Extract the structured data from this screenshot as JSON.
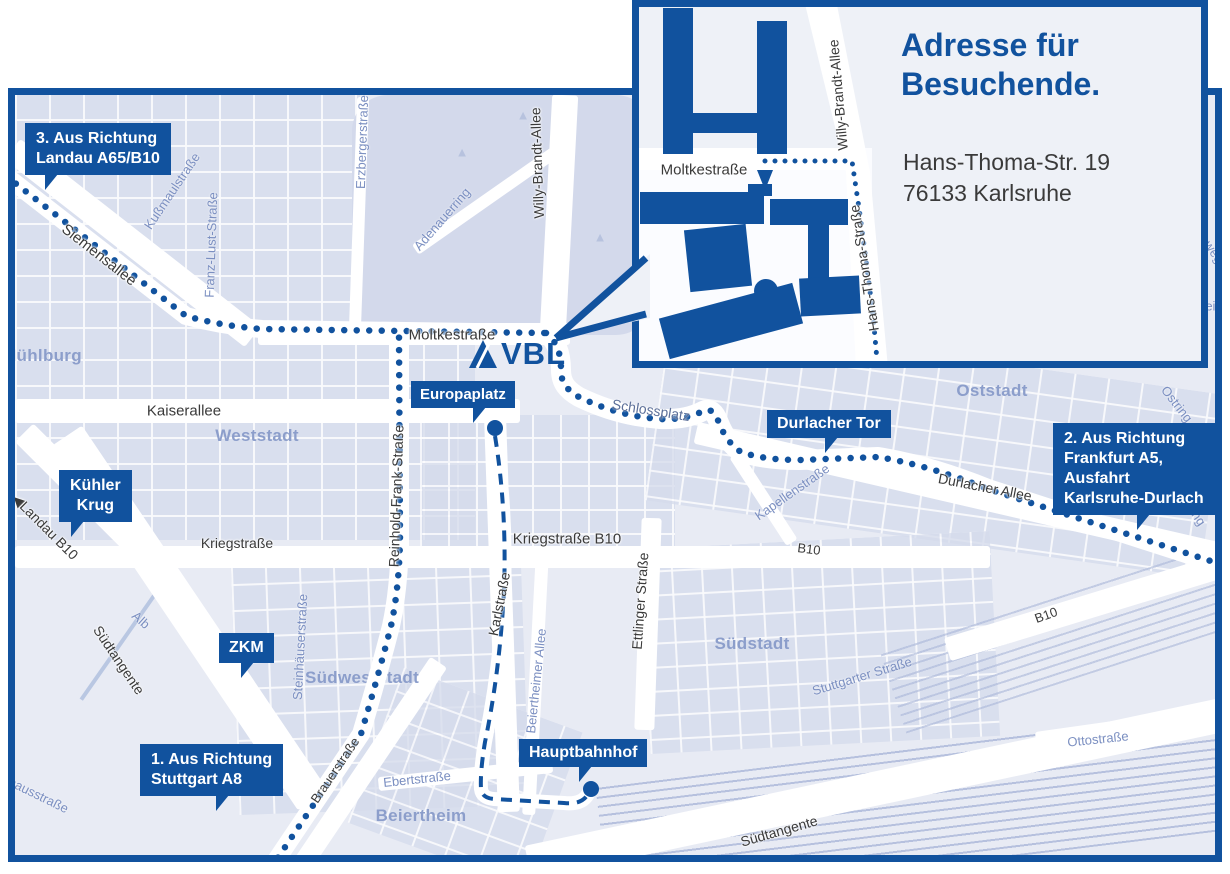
{
  "colors": {
    "brand_blue": "#11529e",
    "map_background": "#e8ebf4",
    "city_block": "#d5dbec",
    "park": "#d3d9eb",
    "area_label": "#8c9ecb",
    "street_minor": "#7b8fc1",
    "street_dark": "#3a3a3a",
    "route": "#11529e",
    "road_white": "#ffffff"
  },
  "inset": {
    "title": [
      "Adresse für",
      "Besuchende."
    ],
    "address": [
      "Hans-Thoma-Str. 19",
      "76133 Karlsruhe"
    ],
    "streets": {
      "moltkestrasse": "Moltkestraße",
      "willy_brandt_allee": "Willy-Brandt-Allee",
      "hans_thoma_strasse": "Hans-Thoma-Straße"
    }
  },
  "logo": {
    "text": "VBL"
  },
  "callouts": {
    "landau": {
      "lines": [
        "3. Aus Richtung",
        "Landau A65/B10"
      ]
    },
    "kuehler_krug": {
      "lines": [
        "Kühler",
        "Krug"
      ]
    },
    "zkm": {
      "lines": [
        "ZKM"
      ]
    },
    "stuttgart": {
      "lines": [
        "1. Aus Richtung",
        "Stuttgart A8"
      ]
    },
    "europaplatz": {
      "lines": [
        "Europaplatz"
      ]
    },
    "durlacher_tor": {
      "lines": [
        "Durlacher Tor"
      ]
    },
    "frankfurt": {
      "lines": [
        "2. Aus Richtung",
        "Frankfurt A5,",
        "Ausfahrt",
        "Karlsruhe-Durlach"
      ]
    },
    "hauptbahnhof": {
      "lines": [
        "Hauptbahnhof"
      ]
    }
  },
  "areas": {
    "muehlburg": "Mühlburg",
    "weststadt": "Weststadt",
    "oststadt": "Oststadt",
    "suedstadt": "Südstadt",
    "suedweststadt": "Südweststadt",
    "beiertheim": "Beiertheim"
  },
  "streets": {
    "siemensallee": "Siemensallee",
    "kussmaulstrasse": "Kußmaulstraße",
    "franz_lust_strasse": "Franz-Lust-Straße",
    "erzbergerstrasse": "Erzbergerstraße",
    "adenauerring": "Adenauerring",
    "willy_brandt_allee": "Willy-Brandt-Allee",
    "moltkestrasse": "Moltkestraße",
    "kaiserallee": "Kaiserallee",
    "landau_b10": "Landau B10",
    "kriegstrasse": "Kriegstraße",
    "kriegstrasse_b10": "Kriegstraße B10",
    "reinhold_frank_strasse": "Reinhold-Frank-Straße",
    "karlstrasse": "Karlstraße",
    "ettlinger_strasse": "Ettlinger Straße",
    "schlossplatz": "Schlossplatz",
    "kapellenstrasse": "Kapellenstraße",
    "durlacher_allee": "Durlacher Allee",
    "b10": "B10",
    "ostring": "Ostring",
    "stuttgarter_strasse": "Stuttgarter Straße",
    "steinhaeuserstrasse": "Steinhäuserstraße",
    "alb": "Alb",
    "suedtangente": "Südtangente",
    "brauerstrasse": "Brauerstraße",
    "ebertstrasse": "Ebertstraße",
    "ottostrasse": "Ottostraße",
    "pulverhausstrasse": "Pulverhausstraße",
    "beiertheimer_allee": "Beiertheimer Allee",
    "fragment_weg": "weg",
    "fragment_ein": "ein"
  },
  "icons": {
    "landau_arrow": "◀",
    "tree": "▲"
  }
}
